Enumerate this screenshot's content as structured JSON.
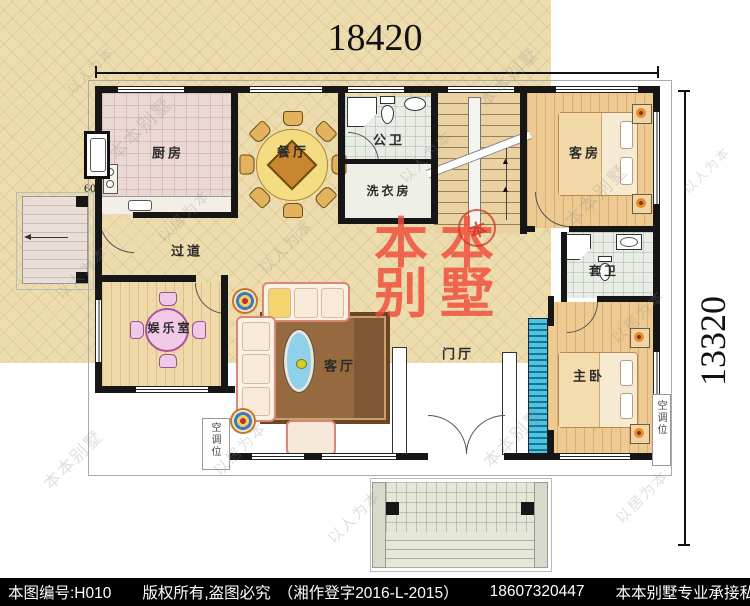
{
  "plan": {
    "dim_width": "18420",
    "dim_height": "13320",
    "dim_side": "600",
    "rooms": [
      {
        "id": "kitchen",
        "label": "厨房"
      },
      {
        "id": "dining",
        "label": "餐厅"
      },
      {
        "id": "public-bath",
        "label": "公卫"
      },
      {
        "id": "laundry",
        "label": "洗衣房"
      },
      {
        "id": "guest-room",
        "label": "客房"
      },
      {
        "id": "hallway",
        "label": "过道"
      },
      {
        "id": "entertainment",
        "label": "娱乐室"
      },
      {
        "id": "living-room",
        "label": "客厅"
      },
      {
        "id": "foyer",
        "label": "门厅"
      },
      {
        "id": "ensuite-bath",
        "label": "套卫"
      },
      {
        "id": "master-bedroom",
        "label": "主卧"
      }
    ],
    "ac_label": "空调位",
    "stair_arrow": "▲"
  },
  "watermark": {
    "brand_line1": "本本",
    "brand_line2": "别墅",
    "seal_char": "本",
    "diagonals": [
      "本本别墅",
      "以人为本",
      "以居为本"
    ]
  },
  "footer": {
    "plan_no": "本图编号:H010",
    "rights": "版权所有,盗图必究",
    "registration": "（湘作登字2016-L-2015）",
    "phone": "18607320447",
    "tagline": "本本别墅专业承接私宅设计"
  },
  "colors": {
    "watermark_red": "#ef4b38",
    "wall": "#161616",
    "hall_floor": "#ecdcae",
    "wood_floor": "#ecca92",
    "screen_blue": "#4cc4e4"
  }
}
